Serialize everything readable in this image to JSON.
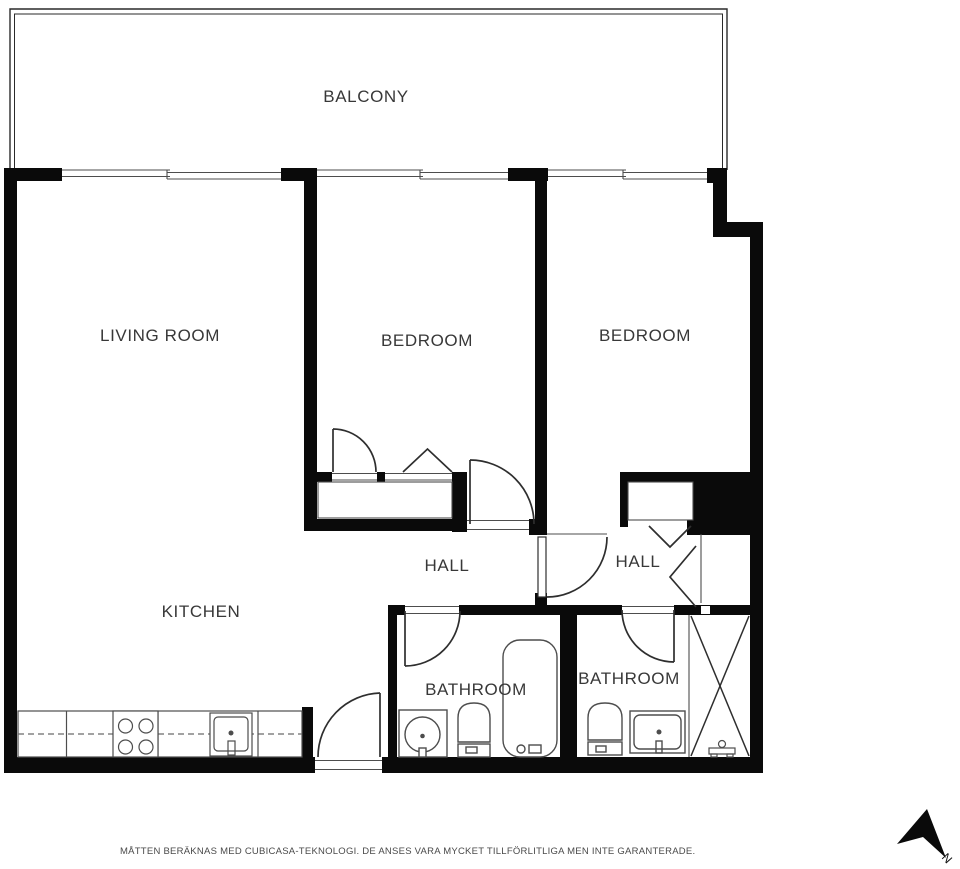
{
  "plan": {
    "type": "floor-plan",
    "rooms": {
      "balcony": {
        "label": "BALCONY"
      },
      "living_room": {
        "label": "LIVING ROOM"
      },
      "bedroom_1": {
        "label": "BEDROOM"
      },
      "bedroom_2": {
        "label": "BEDROOM"
      },
      "hall_1": {
        "label": "HALL"
      },
      "hall_2": {
        "label": "HALL"
      },
      "kitchen": {
        "label": "KITCHEN"
      },
      "bathroom_1": {
        "label": "BATHROOM"
      },
      "bathroom_2": {
        "label": "BATHROOM"
      }
    },
    "footer": {
      "disclaimer": "MÅTTEN BERÄKNAS MED CUBICASA-TEKNOLOGI. DE ANSES VARA MYCKET TILLFÖRLITLIGA MEN INTE GARANTERADE."
    },
    "compass": {
      "north_label": "N"
    },
    "colors": {
      "wall": "#0a0a0a",
      "thin_line": "#4d4d4d",
      "door_line": "#2e2e2e",
      "label_text": "#383838",
      "footer_text": "#4a4a4a"
    }
  }
}
